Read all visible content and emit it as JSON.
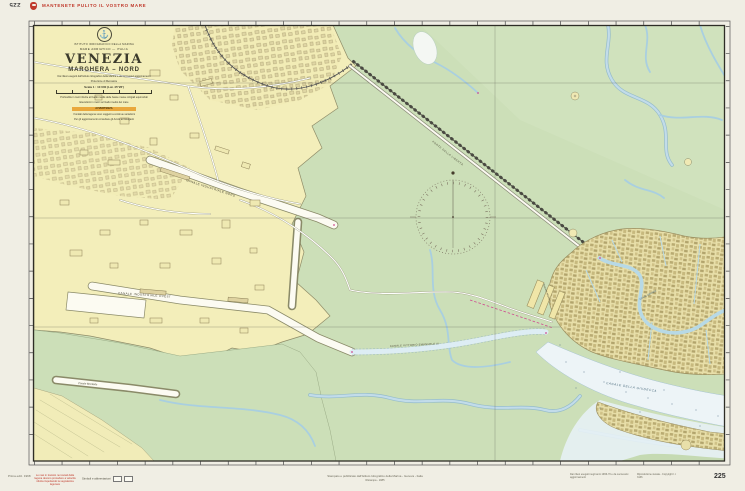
{
  "margins": {
    "chart_number_top": "225",
    "slogan": "MANTENETE PULITO IL VOSTRO MARE",
    "chart_number_bottom": "225",
    "left_note": "Prima ediz. 1968",
    "red_warning": "Le navi in transito nei canali della laguna devono procedere a velocità ridotta rispettando la segnaletica lagunare",
    "symbols_note": "Simboli e abbreviazioni",
    "imprint_line1": "Stampato e pubblicato dall'Istituto Idrografico della Marina - Genova - Italia",
    "imprint_line2": "Ristampa - 1985",
    "right_note1": "Dai rilievi eseguiti negli anni 1966-70 e da successivi aggiornamenti",
    "right_note2": "Riproduzione vietata - Copyright I.I. 3136"
  },
  "title_block": {
    "emblem_glyph": "⚓",
    "institute": "ISTITUTO IDROGRAFICO DELLA MARINA",
    "region": "MARE ADRIATICO — ITALIA",
    "title": "VENEZIA",
    "subtitle": "MARGHERA – NORD",
    "source_note": "Dai rilievi eseguiti dall'Istituto Idrografico della Marina e da successivi aggiornamenti",
    "projection_note": "Proiezione di Mercatore",
    "scale_label": "Scala 1 : 10 000 (Lat. 45°26')",
    "depth_note": "Profondità in metri riferite al livello medio delle basse maree sizigiali equinoziali",
    "height_note": "Elevazioni in metri sul livello medio del mare",
    "advisory": "AVVERTENZA",
    "advisory_text": "I fondali della laguna sono soggetti a continue variazioni",
    "update_note": "Per gli aggiornamenti consultare gli Avvisi ai Naviganti"
  },
  "map_labels": {
    "canale_nord": "CANALE INDUSTRIALE NORD",
    "canale_ovest": "CANALE INDUSTRIALE OVEST",
    "canale_brentella": "Canale Brentella",
    "canale_ve3": "CANALE VITTORIO EMANUELE III",
    "ponte": "PONTE DELLA LIBERTÀ",
    "stazione": "Stazione Marittima",
    "canal_grande": "CANAL GRANDE",
    "giudecca": "CANALE DELLA GIUDECCA"
  },
  "colors": {
    "paper": "#f0eee4",
    "land_yellow": "#f3eeba",
    "lagoon_green": "#ccdfb8",
    "water_blue": "#b9d8e6",
    "canal_white": "#fcfbf2",
    "venice_tan": "#e8dfa9",
    "accent_red": "#c0392b",
    "advisory_orange": "#e9a83d"
  }
}
